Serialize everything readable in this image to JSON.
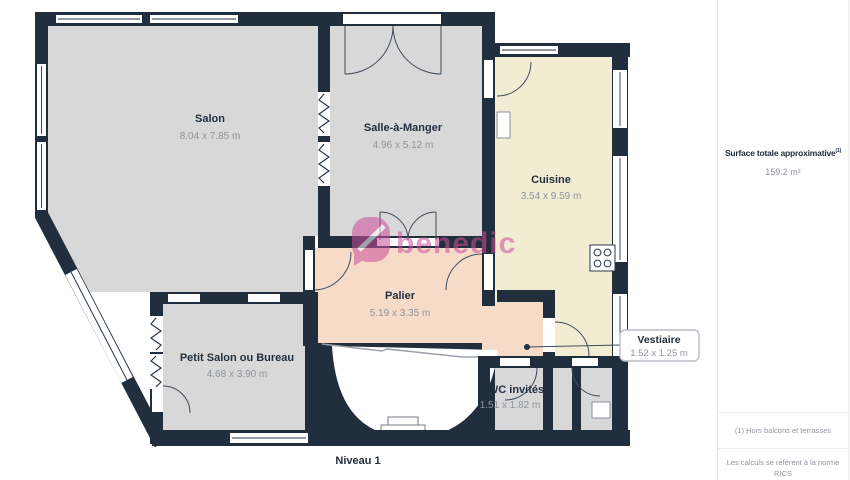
{
  "plan": {
    "level_label": "Niveau 1",
    "watermark": "benedic",
    "rooms": [
      {
        "name": "Salon",
        "dims": "8.04 x 7.85 m"
      },
      {
        "name": "Salle-à-Manger",
        "dims": "4.96 x 5.12 m"
      },
      {
        "name": "Cuisine",
        "dims": "3.54 x 9.59 m"
      },
      {
        "name": "Palier",
        "dims": "5.19 x 3.35 m"
      },
      {
        "name": "Petit Salon ou Bureau",
        "dims": "4.68 x 3.90 m"
      },
      {
        "name": "WC invités",
        "dims": "1.51 x 1.82 m"
      }
    ],
    "callout": {
      "name": "Vestiaire",
      "dims": "1.52 x 1.25 m"
    },
    "colors": {
      "wall": "#212e3e",
      "room_gray": "#d8d8d8",
      "room_cream": "#f2ecd3",
      "room_salmon": "#f6dbc9",
      "watermark_pink": "#cc4e9b"
    }
  },
  "sidebar": {
    "surface_title": "Surface totale approximative",
    "surface_sup": "(1)",
    "surface_value": "159.2 m²",
    "footnote_1": "(1) Hors balcons et terrasses",
    "footnote_2_line1": "Les calculs se réfèrent à la norme RICS",
    "footnote_2_line2": "IPMS 3C. Toutes les mesures sont"
  }
}
